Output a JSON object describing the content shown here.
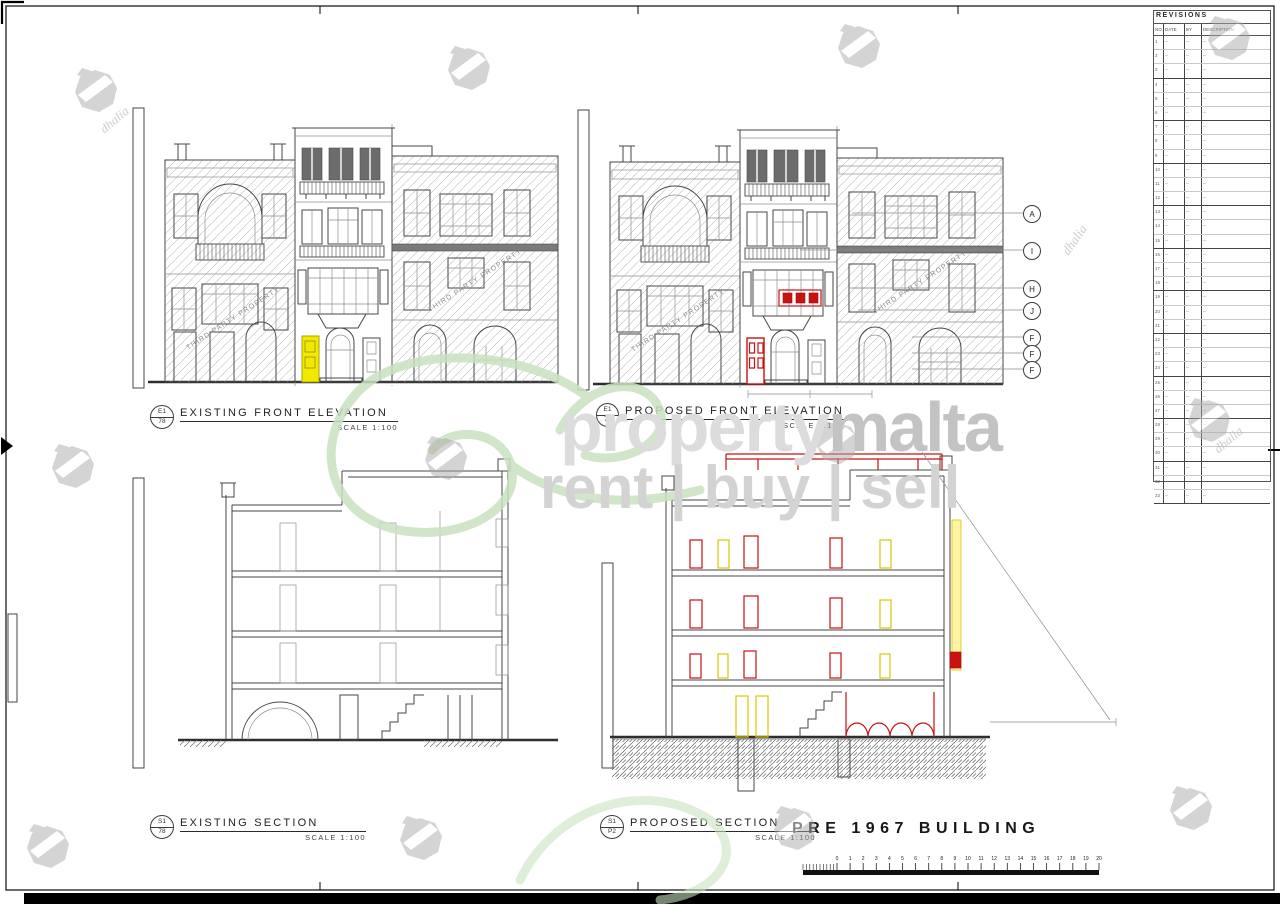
{
  "drawings": [
    {
      "ref_no": "E1",
      "ref_sheet": "78",
      "title": "EXISTING FRONT ELEVATION",
      "scale_label": "SCALE 1:100"
    },
    {
      "ref_no": "E1",
      "ref_sheet": "75",
      "title": "PROPOSED FRONT ELEVATION",
      "scale_label": "SCALE 1:100"
    },
    {
      "ref_no": "S1",
      "ref_sheet": "78",
      "title": "EXISTING SECTION",
      "scale_label": "SCALE 1:100"
    },
    {
      "ref_no": "S1",
      "ref_sheet": "P2",
      "title": "PROPOSED SECTION",
      "scale_label": "SCALE 1:100"
    }
  ],
  "annotations": {
    "building_label": "PRE 1967 BUILDING",
    "third_party_label": "THIRD PARTY PROPERTY",
    "marker_letters": [
      "A",
      "I",
      "H",
      "J",
      "F",
      "F",
      "F"
    ]
  },
  "revisions": {
    "title": "REVISIONS",
    "columns": [
      "NO.",
      "DATE",
      "BY",
      "DESCRIPTION"
    ],
    "placeholder": "--",
    "row_numbers": [
      1,
      2,
      3,
      4,
      5,
      6,
      7,
      8,
      9,
      10,
      11,
      12,
      13,
      14,
      15,
      16,
      17,
      18,
      19,
      20,
      21,
      22,
      23,
      24,
      25,
      26,
      27,
      28,
      29,
      30,
      31,
      32,
      33
    ]
  },
  "scalebar": {
    "numbers": [
      "0",
      "1",
      "2",
      "3",
      "4",
      "5",
      "6",
      "7",
      "8",
      "9",
      "10",
      "11",
      "12",
      "13",
      "14",
      "15",
      "16",
      "17",
      "18",
      "19",
      "20"
    ]
  },
  "watermark": {
    "brand_primary": "property",
    "brand_secondary": "malta",
    "tagline": "rent | buy | sell",
    "logo_name": "dhalia"
  },
  "colors": {
    "existing_highlight": "#f2e800",
    "proposed_highlight": "#cc1111",
    "watermark_green": "#c9e2bf",
    "watermark_gray": "#c6c6c6",
    "line_dark": "#3f3f3f"
  }
}
